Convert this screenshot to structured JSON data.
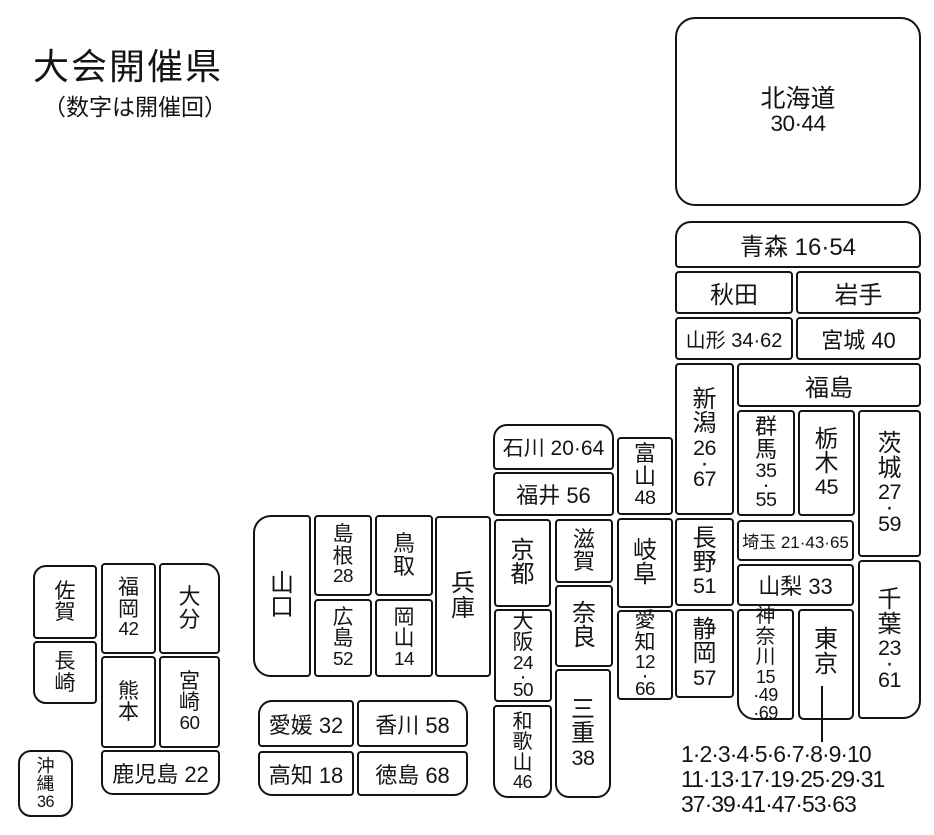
{
  "header": {
    "title": "大会開催県",
    "subtitle": "（数字は開催回）"
  },
  "tokyo_host_numbers": {
    "lines": [
      "1·2·3·4·5·6·7·8·9·10",
      "11·13·17·19·25·29·31",
      "37·39·41·47·53·63"
    ]
  },
  "prefectures": {
    "hokkaido": {
      "lines": [
        "北海道",
        "30·44"
      ]
    },
    "aomori": {
      "label": "青森 16·54"
    },
    "akita": {
      "label": "秋田"
    },
    "iwate": {
      "label": "岩手"
    },
    "yamagata": {
      "label": "山形 34·62"
    },
    "miyagi": {
      "label": "宮城 40"
    },
    "niigata": {
      "lines": [
        "新",
        "潟",
        "26",
        "·",
        "67"
      ]
    },
    "fukushima": {
      "label": "福島"
    },
    "gunma": {
      "lines": [
        "群",
        "馬",
        "35",
        "·",
        "55"
      ]
    },
    "tochigi": {
      "lines": [
        "栃",
        "木",
        "45"
      ]
    },
    "ibaraki": {
      "lines": [
        "茨",
        "城",
        "27",
        "·",
        "59"
      ]
    },
    "nagano": {
      "lines": [
        "長",
        "野",
        "51"
      ]
    },
    "saitama": {
      "label": "埼玉 21·43·65"
    },
    "yamanashi": {
      "label": "山梨 33"
    },
    "chiba": {
      "lines": [
        "千",
        "葉",
        "23",
        "·",
        "61"
      ]
    },
    "shizuoka": {
      "lines": [
        "静",
        "岡",
        "57"
      ]
    },
    "kanagawa": {
      "lines": [
        "神",
        "奈",
        "川",
        "15",
        "·49",
        "·69"
      ]
    },
    "tokyo": {
      "lines": [
        "東",
        "京"
      ]
    },
    "ishikawa": {
      "label": "石川 20·64"
    },
    "fukui": {
      "label": "福井 56"
    },
    "toyama": {
      "lines": [
        "富",
        "山",
        "48"
      ]
    },
    "kyoto": {
      "lines": [
        "京",
        "都"
      ]
    },
    "shiga": {
      "lines": [
        "滋",
        "賀"
      ]
    },
    "gifu": {
      "lines": [
        "岐",
        "阜"
      ]
    },
    "osaka": {
      "lines": [
        "大",
        "阪",
        "24",
        "·",
        "50"
      ]
    },
    "nara": {
      "lines": [
        "奈",
        "良"
      ]
    },
    "aichi": {
      "lines": [
        "愛",
        "知",
        "12",
        "·",
        "66"
      ]
    },
    "mie": {
      "lines": [
        "三",
        "重",
        "38"
      ]
    },
    "wakayama": {
      "lines": [
        "和",
        "歌",
        "山",
        "46"
      ]
    },
    "hyogo": {
      "lines": [
        "兵",
        "庫"
      ]
    },
    "yamaguchi": {
      "lines": [
        "山",
        "口"
      ]
    },
    "shimane": {
      "lines": [
        "島",
        "根",
        "28"
      ]
    },
    "hiroshima": {
      "lines": [
        "広",
        "島",
        "52"
      ]
    },
    "tottori": {
      "lines": [
        "鳥",
        "取"
      ]
    },
    "okayama": {
      "lines": [
        "岡",
        "山",
        "14"
      ]
    },
    "ehime": {
      "label": "愛媛 32"
    },
    "kagawa": {
      "label": "香川 58"
    },
    "kochi": {
      "label": "高知 18"
    },
    "tokushima": {
      "label": "徳島 68"
    },
    "saga": {
      "lines": [
        "佐",
        "賀"
      ]
    },
    "nagasaki": {
      "lines": [
        "長",
        "崎"
      ]
    },
    "fukuoka": {
      "lines": [
        "福",
        "岡",
        "42"
      ]
    },
    "oita": {
      "lines": [
        "大",
        "分"
      ]
    },
    "kumamoto": {
      "lines": [
        "熊",
        "本"
      ]
    },
    "miyazaki": {
      "lines": [
        "宮",
        "崎",
        "60"
      ]
    },
    "kagoshima": {
      "label": "鹿児島 22"
    },
    "okinawa": {
      "lines": [
        "沖",
        "縄",
        "36"
      ]
    }
  }
}
